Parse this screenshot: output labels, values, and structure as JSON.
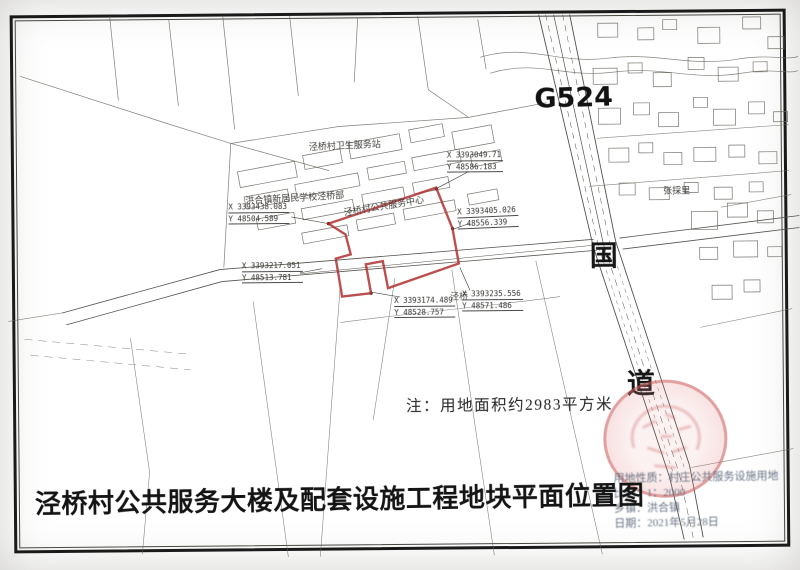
{
  "doc": {
    "title": "泾桥村公共服务大楼及配套设施工程地块平面位置图",
    "note": "注：用地面积约2983平方米"
  },
  "roads": {
    "g524": "G524",
    "guo": "国",
    "dao": "道"
  },
  "labels": {
    "school": "洪合镇新居民学校泾桥部",
    "clinic": "泾桥村卫生服务站",
    "parcel": "泾桥村公共服务中心",
    "village": "张採里",
    "jingqiao": "泾桥"
  },
  "coordinates": [
    {
      "x": "X 3393438.083",
      "y": "Y 48504.589"
    },
    {
      "x": "X 3393049.71",
      "y": "Y 48586.183"
    },
    {
      "x": "X 3393405.026",
      "y": "Y 48556.339"
    },
    {
      "x": "X 3393217.051",
      "y": "Y 48513.781"
    },
    {
      "x": "X 3393174.489",
      "y": "Y 48528.757"
    },
    {
      "x": "X 3393235.556",
      "y": "Y 48571.486"
    }
  ],
  "info": {
    "line1": "用地性质：村庄公共服务设施用地",
    "line2": "比例：1：2000",
    "line3": "乡镇：洪合镇",
    "line4": "日期：2021年5月28日"
  },
  "colors": {
    "parcel_red": "#b03030",
    "stamp_red": "#c85656",
    "line_gray": "#6a675f"
  }
}
